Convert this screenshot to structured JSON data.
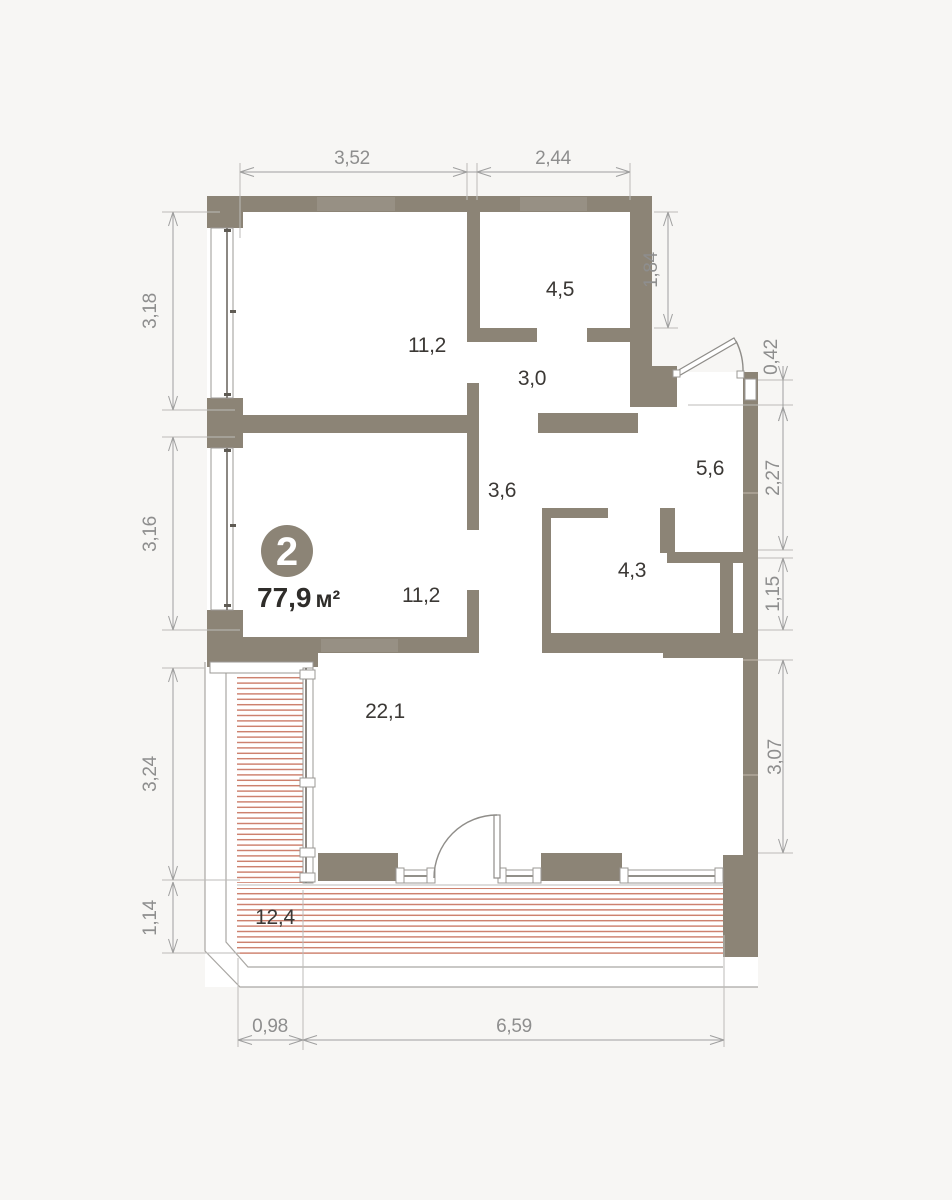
{
  "plan": {
    "unit_number": "2",
    "area_value": "77,9",
    "area_unit": "м²"
  },
  "rooms": [
    {
      "id": "room-top",
      "area": "11,2"
    },
    {
      "id": "wardrobe",
      "area": "4,5"
    },
    {
      "id": "hallway",
      "area": "3,0"
    },
    {
      "id": "entry-hall",
      "area": "5,6"
    },
    {
      "id": "corridor",
      "area": "3,6"
    },
    {
      "id": "bathroom",
      "area": "4,3"
    },
    {
      "id": "room-middle",
      "area": "11,2"
    },
    {
      "id": "living-kitchen",
      "area": "22,1"
    },
    {
      "id": "terrace",
      "area": "12,4"
    }
  ],
  "dimensions": {
    "top": [
      "3,52",
      "2,44"
    ],
    "left": [
      "3,18",
      "3,16",
      "3,24",
      "1,14"
    ],
    "right": [
      "1,84",
      "0,42",
      "2,27",
      "1,15",
      "3,07"
    ],
    "bottom": [
      "0,98",
      "6,59"
    ]
  },
  "colors": {
    "wall": "#8c8476",
    "terrace_hatch": "#cb7c69",
    "dimension_text": "#8e8e8e",
    "room_label": "#3b3835",
    "background": "#f7f6f4"
  }
}
